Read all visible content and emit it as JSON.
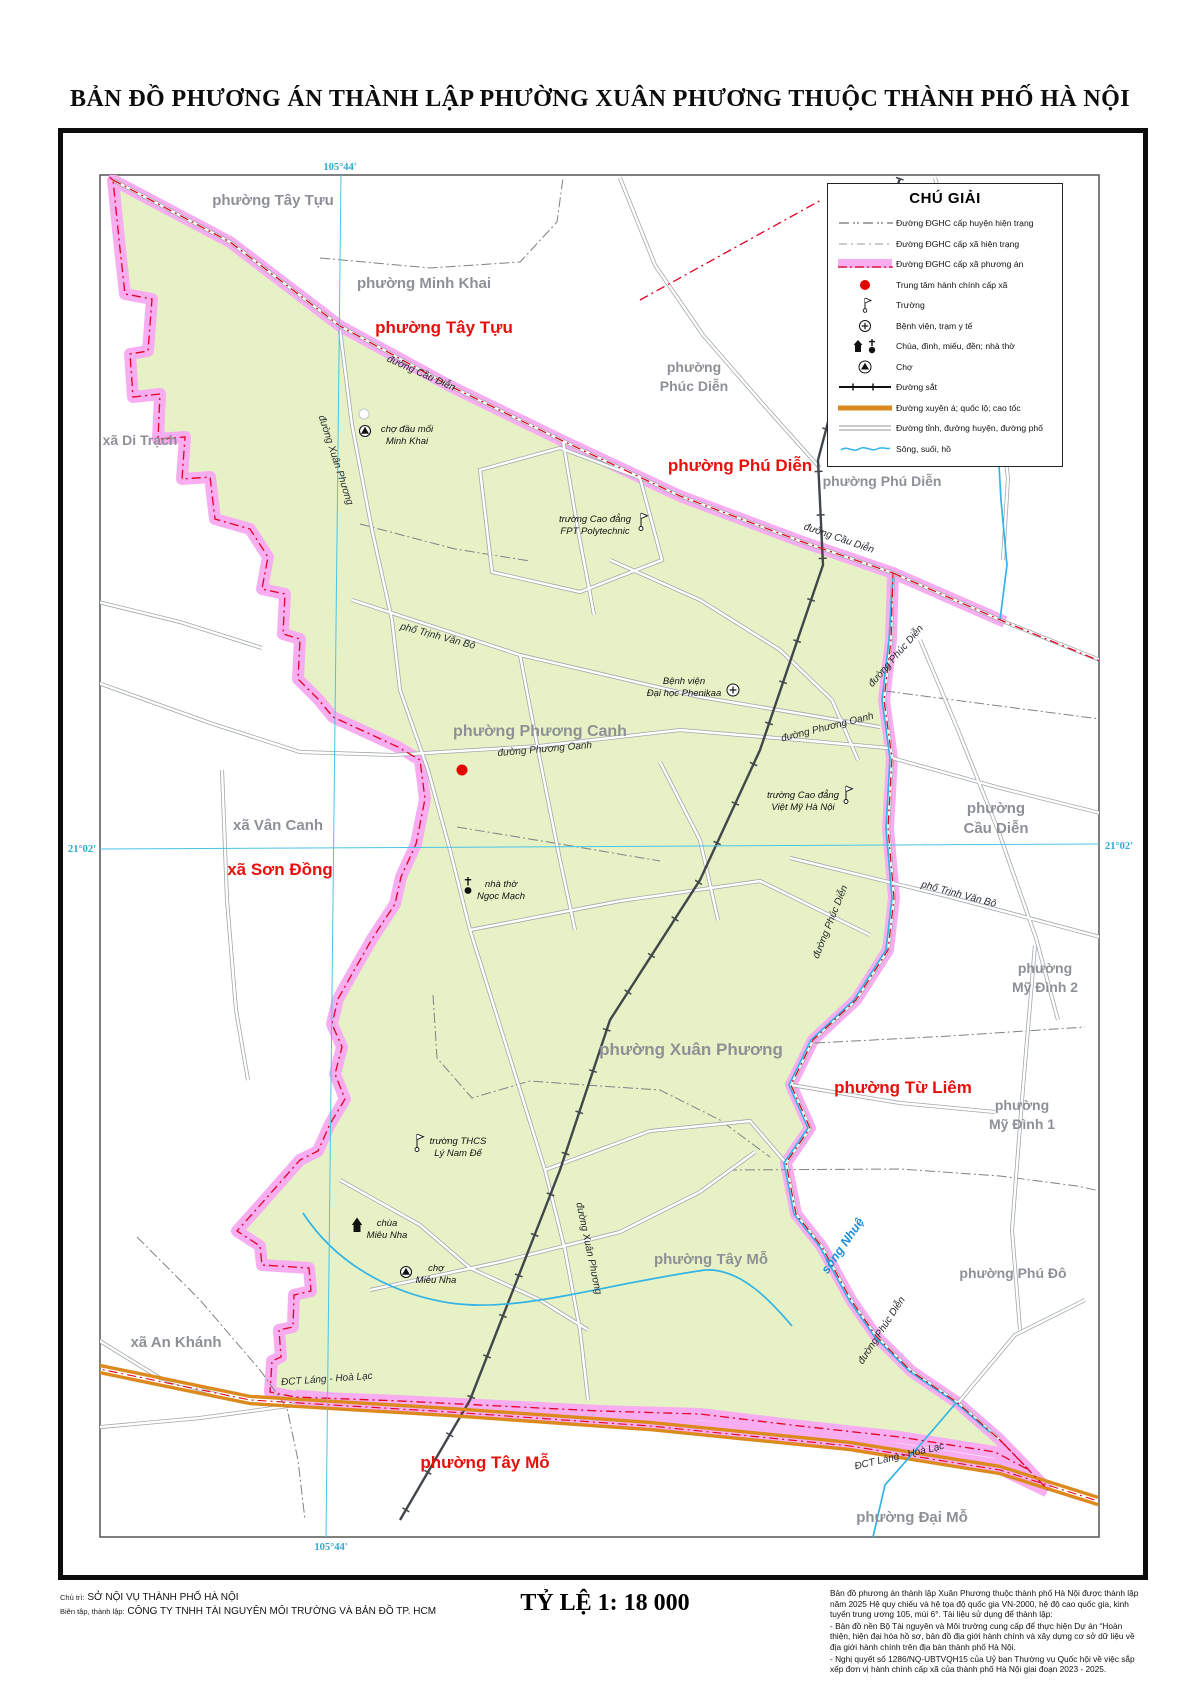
{
  "title": "BẢN ĐỒ PHƯƠNG ÁN THÀNH LẬP PHƯỜNG XUÂN PHƯƠNG THUỘC THÀNH PHỐ HÀ NỘI",
  "legend": {
    "title": "CHÚ GIẢI",
    "items": [
      {
        "symbol": "boundary-district-current",
        "label": "Đường ĐGHC cấp huyện hiện trạng"
      },
      {
        "symbol": "boundary-commune-current",
        "label": "Đường ĐGHC cấp xã hiện trạng"
      },
      {
        "symbol": "boundary-commune-proposed",
        "label": "Đường ĐGHC cấp xã phương án"
      },
      {
        "symbol": "admin-center",
        "label": "Trung tâm hành chính cấp xã"
      },
      {
        "symbol": "school",
        "label": "Trường"
      },
      {
        "symbol": "hospital",
        "label": "Bệnh viện, trạm y tế"
      },
      {
        "symbol": "temple-church",
        "label": "Chùa, đình, miếu, đền; nhà thờ"
      },
      {
        "symbol": "market",
        "label": "Chợ"
      },
      {
        "symbol": "railway",
        "label": "Đường sắt"
      },
      {
        "symbol": "highway",
        "label": "Đường xuyên á; quốc lộ; cao tốc"
      },
      {
        "symbol": "road",
        "label": "Đường tỉnh, đường huyện, đường phố"
      },
      {
        "symbol": "water",
        "label": "Sông, suối, hồ"
      }
    ]
  },
  "map": {
    "graticule_labels": [
      {
        "text": "105°44'",
        "x": 340,
        "y": 170
      },
      {
        "text": "105°44'",
        "x": 331,
        "y": 1550
      },
      {
        "text": "21°02'",
        "x": 82,
        "y": 852
      },
      {
        "text": "21°02'",
        "x": 1119,
        "y": 849
      }
    ],
    "gray_labels": [
      {
        "lines": [
          "phường Tây Tựu"
        ],
        "x": 273,
        "y": 205,
        "size": 15
      },
      {
        "lines": [
          "phường Minh Khai"
        ],
        "x": 424,
        "y": 288,
        "size": 15
      },
      {
        "lines": [
          "xã Di Trạch"
        ],
        "x": 140,
        "y": 445,
        "size": 14
      },
      {
        "lines": [
          "phường",
          "Phúc Diễn"
        ],
        "x": 694,
        "y": 372,
        "size": 14
      },
      {
        "lines": [
          "phường Phú Diễn"
        ],
        "x": 882,
        "y": 486,
        "size": 14
      },
      {
        "lines": [
          "phường Phương Canh"
        ],
        "x": 540,
        "y": 736,
        "size": 16
      },
      {
        "lines": [
          "xã Vân Canh"
        ],
        "x": 278,
        "y": 830,
        "size": 15
      },
      {
        "lines": [
          "phường",
          "Cầu Diễn"
        ],
        "x": 996,
        "y": 813,
        "size": 15
      },
      {
        "lines": [
          "phường",
          "Mỹ Đình 2"
        ],
        "x": 1045,
        "y": 973,
        "size": 14
      },
      {
        "lines": [
          "phường Xuân Phương"
        ],
        "x": 691,
        "y": 1055,
        "size": 17
      },
      {
        "lines": [
          "phường",
          "Mỹ Đình 1"
        ],
        "x": 1022,
        "y": 1110,
        "size": 14
      },
      {
        "lines": [
          "phường Tây Mỗ"
        ],
        "x": 711,
        "y": 1264,
        "size": 15
      },
      {
        "lines": [
          "phường Phú Đô"
        ],
        "x": 1013,
        "y": 1278,
        "size": 14
      },
      {
        "lines": [
          "xã An Khánh"
        ],
        "x": 176,
        "y": 1347,
        "size": 15
      },
      {
        "lines": [
          "phường Đại Mỗ"
        ],
        "x": 912,
        "y": 1522,
        "size": 15
      }
    ],
    "red_labels": [
      {
        "text": "phường Tây Tựu",
        "x": 444,
        "y": 333
      },
      {
        "text": "phường Phú Diễn",
        "x": 740,
        "y": 471
      },
      {
        "text": "xã Sơn Đồng",
        "x": 280,
        "y": 875
      },
      {
        "text": "phường Từ Liêm",
        "x": 903,
        "y": 1093
      },
      {
        "text": "phường Tây Mỗ",
        "x": 485,
        "y": 1468
      }
    ],
    "road_labels": [
      {
        "text": "đường Cầu Diễn",
        "x": 420,
        "y": 376,
        "rot": 24
      },
      {
        "text": "đường Xuân Phương",
        "x": 333,
        "y": 461,
        "rot": 72
      },
      {
        "text": "phố Trịnh Văn Bô",
        "x": 437,
        "y": 639,
        "rot": 15
      },
      {
        "text": "đường Cầu Diễn",
        "x": 838,
        "y": 541,
        "rot": 19
      },
      {
        "text": "đường Phúc Diễn",
        "x": 898,
        "y": 658,
        "rot": -49
      },
      {
        "text": "đường Phương Oanh",
        "x": 828,
        "y": 730,
        "rot": -14
      },
      {
        "text": "đường Phương Oanh",
        "x": 545,
        "y": 752,
        "rot": -5
      },
      {
        "text": "phố Trịnh Văn Bô",
        "x": 958,
        "y": 897,
        "rot": 15
      },
      {
        "text": "đường Phúc Diễn",
        "x": 833,
        "y": 923,
        "rot": -68
      },
      {
        "text": "đường Xuân Phương",
        "x": 586,
        "y": 1249,
        "rot": 78
      },
      {
        "text": "đường Phúc Diễn",
        "x": 884,
        "y": 1332,
        "rot": -57
      },
      {
        "text": "ĐCT Láng - Hoà Lạc",
        "x": 327,
        "y": 1382,
        "rot": -4
      },
      {
        "text": "ĐCT Láng - Hoà Lạc",
        "x": 900,
        "y": 1459,
        "rot": -13
      }
    ],
    "water_labels": [
      {
        "text": "sông Nhuệ",
        "x": 846,
        "y": 1248,
        "rot": -55
      }
    ],
    "pois": [
      {
        "type": "market",
        "x": 365,
        "y": 431,
        "lines": [
          "chợ đầu mối",
          "Minh Khai"
        ],
        "lx": 407,
        "ly": 432
      },
      {
        "type": "school",
        "x": 641,
        "y": 522,
        "lines": [
          "trường Cao đẳng",
          "FPT Polytechnic"
        ],
        "lx": 595,
        "ly": 522
      },
      {
        "type": "hospital",
        "x": 733,
        "y": 690,
        "lines": [
          "Bệnh viện",
          "Đại học Phenikaa"
        ],
        "lx": 684,
        "ly": 684
      },
      {
        "type": "school",
        "x": 846,
        "y": 795,
        "lines": [
          "trường Cao đẳng",
          "Việt Mỹ Hà Nội"
        ],
        "lx": 803,
        "ly": 798
      },
      {
        "type": "church",
        "x": 468,
        "y": 888,
        "lines": [
          "nhà thờ",
          "Ngọc Mạch"
        ],
        "lx": 501,
        "ly": 887
      },
      {
        "type": "school",
        "x": 417,
        "y": 1143,
        "lines": [
          "trường THCS",
          "Lý Nam Đế"
        ],
        "lx": 458,
        "ly": 1144
      },
      {
        "type": "pagoda",
        "x": 357,
        "y": 1227,
        "lines": [
          "chùa",
          "Miêu Nha"
        ],
        "lx": 387,
        "ly": 1226
      },
      {
        "type": "market",
        "x": 406,
        "y": 1272,
        "lines": [
          "chợ",
          "Miêu Nha"
        ],
        "lx": 436,
        "ly": 1271
      },
      {
        "type": "admin-dot",
        "x": 462,
        "y": 770
      }
    ]
  },
  "footer": {
    "credit1_prefix": "Chủ trì:",
    "credit1": "SỞ NỘI VỤ THÀNH PHỐ HÀ NỘI",
    "credit2_prefix": "Biên tập, thành lập:",
    "credit2": "CÔNG TY TNHH TÀI NGUYÊN MÔI TRƯỜNG VÀ BẢN ĐỒ TP. HCM",
    "scale": "TỶ LỆ 1: 18 000",
    "notes": [
      "Bản đồ phương án thành lập Xuân Phương thuộc thành phố Hà Nội được thành lập năm 2025 Hệ quy chiếu và hệ tọa độ quốc gia VN-2000, hệ độ cao quốc gia, kinh tuyến trung ương 105, múi 6°. Tài liệu sử dụng để thành lập:",
      "- Bản đồ nền Bộ Tài nguyên và Môi trường cung cấp để thực hiện Dự án “Hoàn thiện, hiện đại hóa hồ sơ, bản đồ địa giới hành chính và xây dựng cơ sở dữ liệu về địa giới hành chính trên địa bàn thành phố Hà Nội.",
      "- Nghị quyết số 1286/NQ-UBTVQH15 của Uỷ ban Thường vụ Quốc hội về việc sắp xếp đơn vị hành chính cấp xã của thành phố Hà Nội giai đoạn 2023 - 2025."
    ]
  },
  "colors": {
    "ward_fill": "#e6f2c6",
    "proposed_boundary_pink": "#f7adf0",
    "boundary_red": "#e30022",
    "highway_orange": "#dc8a1e",
    "water_cyan": "#33b3e6",
    "graticule_cyan": "#49c3e8",
    "railway_dark": "#41464b",
    "gray_label": "#8d9196",
    "red_label": "#e8100c"
  }
}
